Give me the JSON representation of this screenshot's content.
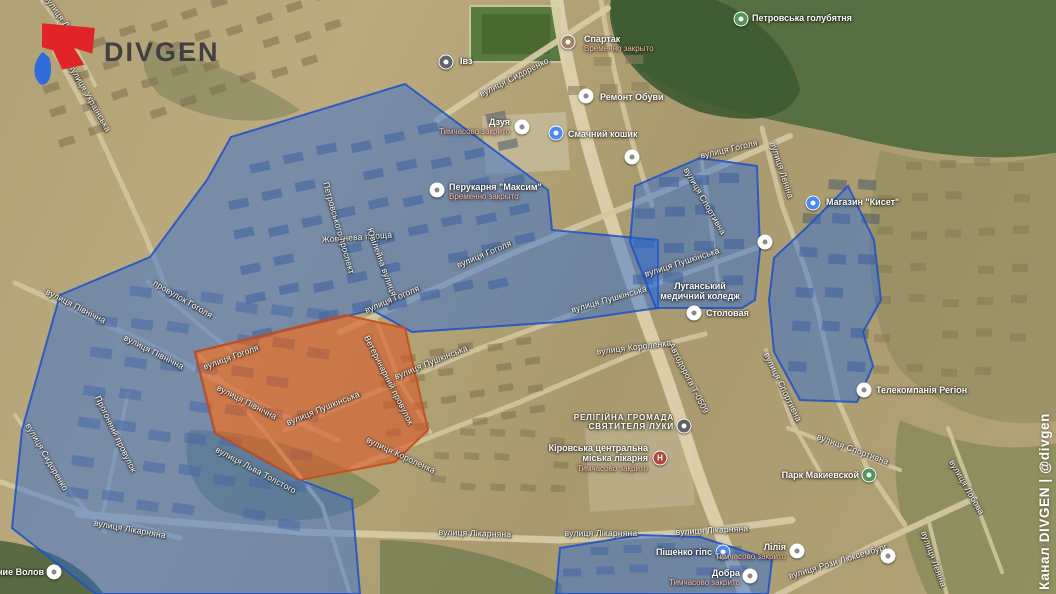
{
  "branding": {
    "logo_text": "DIVGEN",
    "watermark": "Канал DIVGEN | @divgen"
  },
  "colors": {
    "zone_blue_fill": "rgba(40,104,219,0.45)",
    "zone_blue_stroke": "rgba(28,80,200,0.85)",
    "zone_orange_fill": "rgba(219,86,38,0.58)",
    "zone_orange_stroke": "rgba(196,77,29,0.9)",
    "logo_red": "#e02427",
    "logo_blue": "#2f6bd9",
    "markers": {
      "white": "#ffffff",
      "blue": "#4a89f3",
      "green": "#519657",
      "brown": "#a0815f",
      "dark": "#5f6368",
      "hospital": "#b0453a",
      "community": "#5f6368"
    }
  },
  "map": {
    "zones": {
      "blue": [
        {
          "points": "405,84 548,190 552,230 658,240 658,308 560,322 412,332 372,310 195,352 215,433 300,480 352,500 360,594 96,594 12,528 22,430 60,295 150,257 207,180 231,137"
        },
        {
          "points": "635,186 700,158 757,166 760,250 755,300 742,308 656,308 630,242"
        },
        {
          "points": "806,228 848,186 874,240 881,300 863,332 873,366 857,402 800,400 774,352 769,300 774,258"
        },
        {
          "points": "560,548 640,535 700,537 772,560 768,594 556,594"
        }
      ],
      "orange": [
        {
          "points": "195,352 345,315 405,328 428,430 395,462 300,480 215,433"
        }
      ]
    },
    "street_labels": [
      {
        "t": "вулиця Дзюби",
        "x": 63,
        "y": 20,
        "r": 55
      },
      {
        "t": "вулиця Українська",
        "x": 90,
        "y": 98,
        "r": 60
      },
      {
        "t": "вулиця Сидоренко",
        "x": 514,
        "y": 77,
        "r": -27
      },
      {
        "t": "вулиця Гоголя",
        "x": 484,
        "y": 254,
        "r": -23
      },
      {
        "t": "вулиця Гоголя",
        "x": 392,
        "y": 299,
        "r": -23
      },
      {
        "t": "вулиця Гоголя",
        "x": 231,
        "y": 357,
        "r": -20
      },
      {
        "t": "провулок Гоголя",
        "x": 183,
        "y": 299,
        "r": 30
      },
      {
        "t": "вулиця Гоголя",
        "x": 729,
        "y": 149,
        "r": -13
      },
      {
        "t": "Жовтнева площа",
        "x": 357,
        "y": 237,
        "r": -4
      },
      {
        "t": "Петровського проспект",
        "x": 339,
        "y": 228,
        "r": 74
      },
      {
        "t": "Ювілейна вулиця",
        "x": 382,
        "y": 262,
        "r": 70
      },
      {
        "t": "вулиця Північна",
        "x": 76,
        "y": 306,
        "r": 27
      },
      {
        "t": "вулиця Північна",
        "x": 154,
        "y": 352,
        "r": 27
      },
      {
        "t": "вулиця Північна",
        "x": 247,
        "y": 402,
        "r": 27
      },
      {
        "t": "вулиця Сидоренко",
        "x": 47,
        "y": 457,
        "r": 60
      },
      {
        "t": "Прогонний провулок",
        "x": 116,
        "y": 434,
        "r": 64
      },
      {
        "t": "вулиця Лікарняна",
        "x": 130,
        "y": 529,
        "r": 10
      },
      {
        "t": "вулиця Лікарняна",
        "x": 475,
        "y": 533,
        "r": 2
      },
      {
        "t": "вулиця Лікарняна",
        "x": 601,
        "y": 533,
        "r": 0
      },
      {
        "t": "вулиця Лікарняна",
        "x": 712,
        "y": 530,
        "r": -3
      },
      {
        "t": "вулиця Льва Толстого",
        "x": 256,
        "y": 470,
        "r": 28
      },
      {
        "t": "вулиця Пушкінська",
        "x": 323,
        "y": 408,
        "r": -22
      },
      {
        "t": "вулиця Пушкінська",
        "x": 431,
        "y": 362,
        "r": -22
      },
      {
        "t": "вулиця Пушкінська",
        "x": 609,
        "y": 299,
        "r": -16
      },
      {
        "t": "вулиця Пушкінська",
        "x": 682,
        "y": 262,
        "r": -18
      },
      {
        "t": "Ветеринарний провулок",
        "x": 389,
        "y": 380,
        "r": 63
      },
      {
        "t": "вулиця Короленка",
        "x": 401,
        "y": 455,
        "r": 25
      },
      {
        "t": "вулиця Короленка",
        "x": 634,
        "y": 347,
        "r": -7
      },
      {
        "t": "Автодорога Т-0509",
        "x": 689,
        "y": 378,
        "r": 63
      },
      {
        "t": "вулиця Леніна",
        "x": 782,
        "y": 170,
        "r": 72
      },
      {
        "t": "вулиця Спортивна",
        "x": 705,
        "y": 201,
        "r": 60
      },
      {
        "t": "вулиця Спортивна",
        "x": 783,
        "y": 387,
        "r": 64
      },
      {
        "t": "вулиця Спортивна",
        "x": 853,
        "y": 449,
        "r": 20
      },
      {
        "t": "вулиця Леніна",
        "x": 934,
        "y": 559,
        "r": 70
      },
      {
        "t": "вулиця Рози Люксембург",
        "x": 838,
        "y": 561,
        "r": -17
      },
      {
        "t": "вулиця Лобова",
        "x": 967,
        "y": 487,
        "r": 60
      }
    ],
    "pois": [
      {
        "id": "ivz",
        "lines": [
          "Івз"
        ],
        "align": "left",
        "lx": 460,
        "ly": 56,
        "marker": {
          "type": "dark",
          "x": 446,
          "y": 62
        }
      },
      {
        "id": "spartak",
        "lines": [
          "Спартак"
        ],
        "closed": "Временно закрыто",
        "align": "left",
        "lx": 584,
        "ly": 34,
        "marker": {
          "type": "brown",
          "x": 568,
          "y": 42
        }
      },
      {
        "id": "remont-obuvi",
        "lines": [
          "Ремонт Обуви"
        ],
        "align": "left",
        "lx": 600,
        "ly": 92,
        "marker": {
          "type": "white",
          "x": 586,
          "y": 96
        }
      },
      {
        "id": "dzuya",
        "lines": [
          "Дзуя"
        ],
        "closed": "Тимчасово закрито",
        "align": "right",
        "lx": 510,
        "ly": 117,
        "marker": {
          "type": "white",
          "x": 522,
          "y": 127
        }
      },
      {
        "id": "smachnyi-koshyk",
        "lines": [
          "Смачний кошик"
        ],
        "align": "left",
        "lx": 568,
        "ly": 129,
        "marker": {
          "type": "blue",
          "x": 556,
          "y": 133
        }
      },
      {
        "id": "perukarnia-maksym",
        "lines": [
          "Перукарня \"Максим\""
        ],
        "closed": "Временно закрыто",
        "align": "left",
        "lx": 449,
        "ly": 182,
        "marker": {
          "type": "white",
          "x": 437,
          "y": 190
        }
      },
      {
        "id": "holubiatnia",
        "lines": [
          "Петровська голубятня"
        ],
        "align": "left",
        "lx": 752,
        "ly": 13,
        "marker": {
          "type": "green",
          "x": 741,
          "y": 19
        }
      },
      {
        "id": "mahazyn-kyset",
        "lines": [
          "Магазин \"Кисет\""
        ],
        "align": "left",
        "lx": 826,
        "ly": 197,
        "marker": {
          "type": "blue",
          "x": 813,
          "y": 203
        }
      },
      {
        "id": "medychnyi-koledzh",
        "lines": [
          "Луганський",
          "медичний коледж"
        ],
        "align": "center",
        "lx": 700,
        "ly": 281,
        "marker": null
      },
      {
        "id": "stolovaya",
        "lines": [
          "Столовая"
        ],
        "align": "left",
        "lx": 706,
        "ly": 308,
        "marker": {
          "type": "white",
          "x": 694,
          "y": 313
        }
      },
      {
        "id": "hromada-luky",
        "caps": true,
        "lines": [
          "РЕЛІГІЙНА ГРОМАДА",
          "СВЯТИТЕЛЯ ЛУКИ"
        ],
        "align": "right",
        "lx": 674,
        "ly": 413,
        "marker": {
          "type": "community",
          "x": 684,
          "y": 426
        }
      },
      {
        "id": "miska-likarnia",
        "lines": [
          "Кіровська центральна",
          "міська лікарня"
        ],
        "closed": "Тимчасово закрито",
        "align": "right",
        "lx": 648,
        "ly": 443,
        "marker": {
          "type": "hospital",
          "x": 660,
          "y": 458
        }
      },
      {
        "id": "telekompania-rehion",
        "lines": [
          "Телекомпанія Регіон"
        ],
        "align": "left",
        "lx": 876,
        "ly": 385,
        "marker": {
          "type": "white",
          "x": 864,
          "y": 390
        }
      },
      {
        "id": "park-makiyevskoi",
        "lines": [
          "Парк Макиевской"
        ],
        "align": "right",
        "lx": 859,
        "ly": 470,
        "marker": {
          "type": "green",
          "x": 869,
          "y": 475
        }
      },
      {
        "id": "pishenko-hips",
        "lines": [
          "Пішенко гіпс"
        ],
        "align": "right",
        "lx": 712,
        "ly": 547,
        "marker": {
          "type": "blue",
          "x": 723,
          "y": 552
        }
      },
      {
        "id": "liliya",
        "lines": [
          "Лілія"
        ],
        "closed": "Тимчасово закрито",
        "align": "right",
        "lx": 786,
        "ly": 542,
        "marker": {
          "type": "white",
          "x": 797,
          "y": 551
        }
      },
      {
        "id": "dobra",
        "lines": [
          "Добра"
        ],
        "closed": "Тимчасово закрито",
        "align": "right",
        "lx": 740,
        "ly": 568,
        "marker": {
          "type": "white",
          "x": 750,
          "y": 576
        }
      },
      {
        "id": "volov",
        "lines": [
          "ление Волов"
        ],
        "align": "right",
        "lx": 44,
        "ly": 567,
        "marker": {
          "type": "white",
          "x": 54,
          "y": 572
        }
      },
      {
        "id": "poi-a",
        "lines": [],
        "marker": {
          "type": "white",
          "x": 632,
          "y": 157
        }
      },
      {
        "id": "poi-b",
        "lines": [],
        "marker": {
          "type": "white",
          "x": 765,
          "y": 242
        }
      },
      {
        "id": "poi-c",
        "lines": [],
        "marker": {
          "type": "white",
          "x": 888,
          "y": 556
        }
      }
    ]
  }
}
